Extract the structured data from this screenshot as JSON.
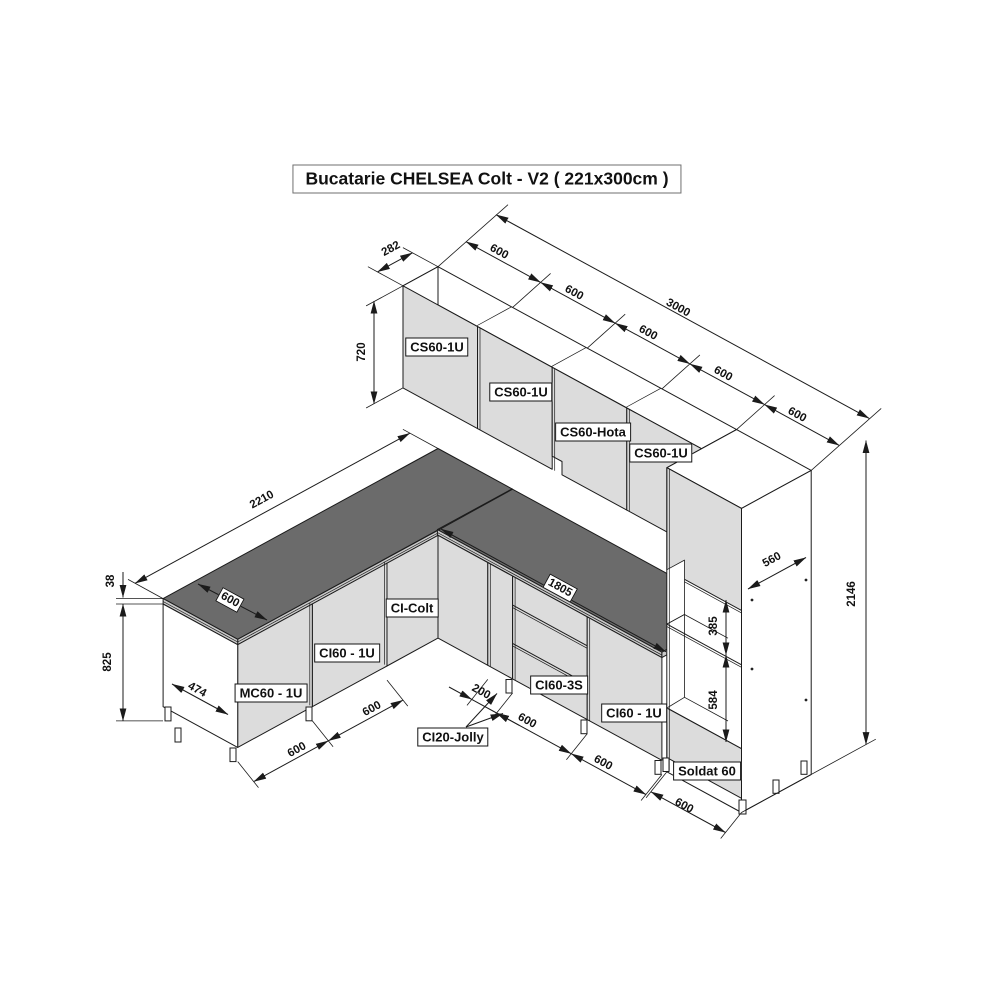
{
  "title": "Bucatarie CHELSEA Colt - V2 ( 221x300cm )",
  "colors": {
    "cabinet_front": "#dcdcdc",
    "countertop_top": "#6b6b6b",
    "countertop_edge": "#c9c9c9",
    "line": "#1b1b1b",
    "face_white": "#ffffff"
  },
  "labels": {
    "wall_cab_1": "CS60-1U",
    "wall_cab_2": "CS60-1U",
    "wall_cab_hood": "CS60-Hota",
    "wall_cab_3": "CS60-1U",
    "corner_cab": "CI-Colt",
    "base_left_door": "CI60 - 1U",
    "base_left_sink": "MC60 - 1U",
    "base_right_drawers": "CI60-3S",
    "base_right_door": "CI60 - 1U",
    "base_right_jolly": "CI20-Jolly",
    "tall_unit": "Soldat 60"
  },
  "dims": {
    "wall_depth": "282",
    "top_seg_1": "600",
    "top_seg_2": "600",
    "top_seg_3": "600",
    "top_seg_4": "600",
    "top_seg_5": "600",
    "total_right": "3000",
    "wall_height": "720",
    "total_left": "2210",
    "counter_depth": "600",
    "counter_thickness": "38",
    "base_height": "825",
    "side_depth": "474",
    "left_seg_1": "600",
    "left_seg_2": "600",
    "jolly_width": "200",
    "right_seg_1": "600",
    "right_seg_2": "600",
    "right_seg_3": "600",
    "right_counter_length": "1805",
    "tall_depth": "560",
    "total_height": "2146",
    "niche_top": "385",
    "niche_oven": "584"
  }
}
